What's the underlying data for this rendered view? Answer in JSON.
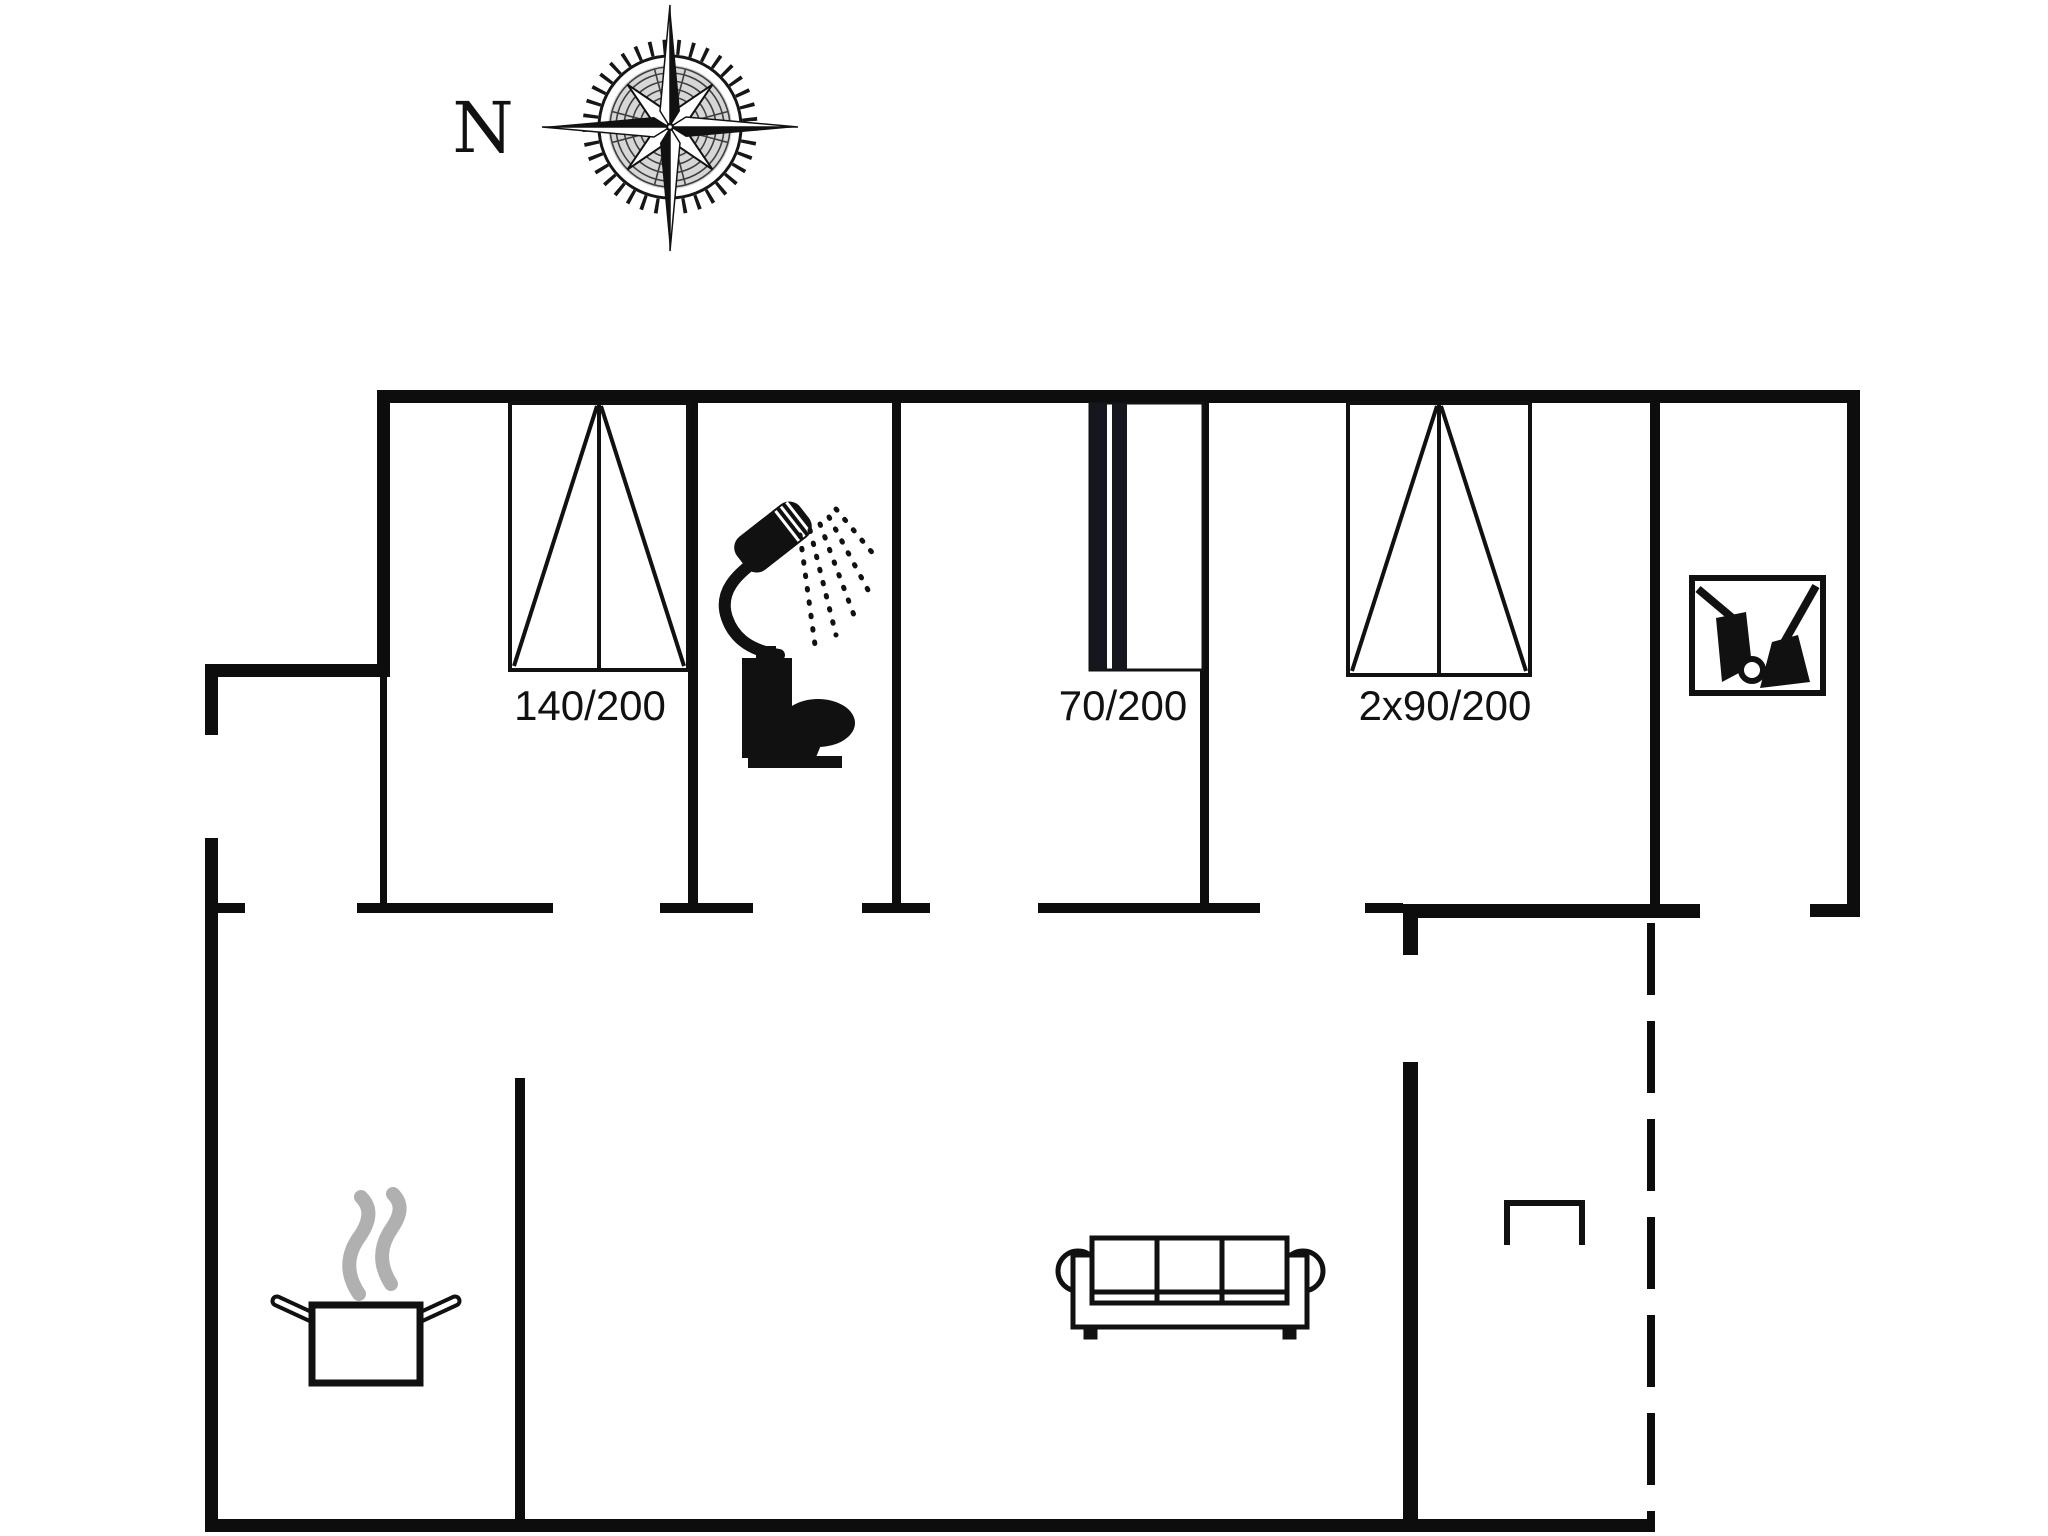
{
  "compass": {
    "label": "N"
  },
  "bed_labels": {
    "double": "140/200",
    "single": "70/200",
    "twin": "2x90/200"
  },
  "palette": {
    "paper": "#ffffff",
    "line": "#0d0d0d",
    "steam": "#b0b0b0"
  },
  "icons": [
    "compass-rose-icon",
    "shower-icon",
    "toilet-icon",
    "cleaning-equipment-icon",
    "cooking-pot-icon",
    "sofa-icon",
    "wardrobe-bracket-icon"
  ]
}
